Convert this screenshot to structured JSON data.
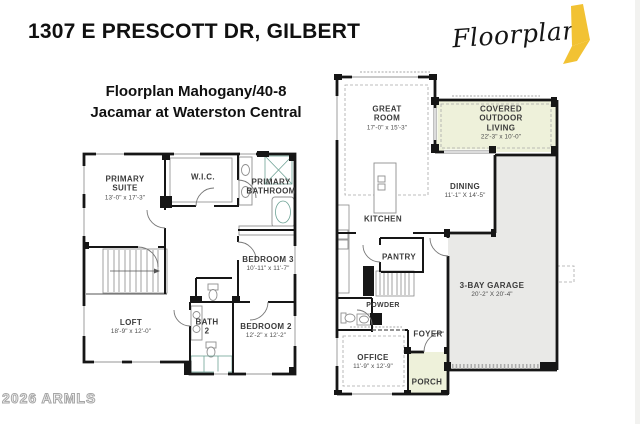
{
  "header": {
    "address": "1307 E PRESCOTT DR, GILBERT",
    "plan_name": "Floorplan Mahogany/40-8",
    "community": "Jacamar at Waterston Central"
  },
  "logo": {
    "wordmark": "Floorplan",
    "accent_color": "#F2C233"
  },
  "watermark": "2026 ARMLS",
  "colors": {
    "wall": "#161616",
    "tint_outdoor": "#EEF1DA",
    "garage_fill": "#E9E9E7",
    "fixture_teal": "#D8ECE3"
  },
  "floors": {
    "upper": {
      "title": "Upper Floor",
      "rooms": [
        {
          "id": "primary-suite",
          "label": "PRIMARY SUITE",
          "dims": "13'-0\" x 17'-3\""
        },
        {
          "id": "wic",
          "label": "W.I.C.",
          "dims": ""
        },
        {
          "id": "primary-bathroom",
          "label": "PRIMARY BATHROOM",
          "dims": ""
        },
        {
          "id": "bedroom-3",
          "label": "BEDROOM 3",
          "dims": "10'-11\" x 11'-7\""
        },
        {
          "id": "loft",
          "label": "LOFT",
          "dims": "18'-9\" x 12'-0\""
        },
        {
          "id": "bath-2",
          "label": "BATH 2",
          "dims": ""
        },
        {
          "id": "bedroom-2",
          "label": "BEDROOM 2",
          "dims": "12'-2\" x 12'-2\""
        }
      ]
    },
    "main": {
      "title": "Main Floor",
      "rooms": [
        {
          "id": "great-room",
          "label": "GREAT ROOM",
          "dims": "17'-0\" x 15'-3\""
        },
        {
          "id": "covered-outdoor-living",
          "label": "COVERED OUTDOOR LIVING",
          "dims": "22'-3\" x 10'-0\""
        },
        {
          "id": "kitchen",
          "label": "KITCHEN",
          "dims": ""
        },
        {
          "id": "dining",
          "label": "DINING",
          "dims": "11'-1\" X 14'-5\""
        },
        {
          "id": "pantry",
          "label": "PANTRY",
          "dims": ""
        },
        {
          "id": "powder",
          "label": "POWDER",
          "dims": ""
        },
        {
          "id": "foyer",
          "label": "FOYER",
          "dims": ""
        },
        {
          "id": "office",
          "label": "OFFICE",
          "dims": "11'-9\" x 12'-9\""
        },
        {
          "id": "porch",
          "label": "PORCH",
          "dims": ""
        },
        {
          "id": "garage",
          "label": "3-BAY GARAGE",
          "dims": "20'-2\" X 20'-4\""
        }
      ]
    }
  }
}
